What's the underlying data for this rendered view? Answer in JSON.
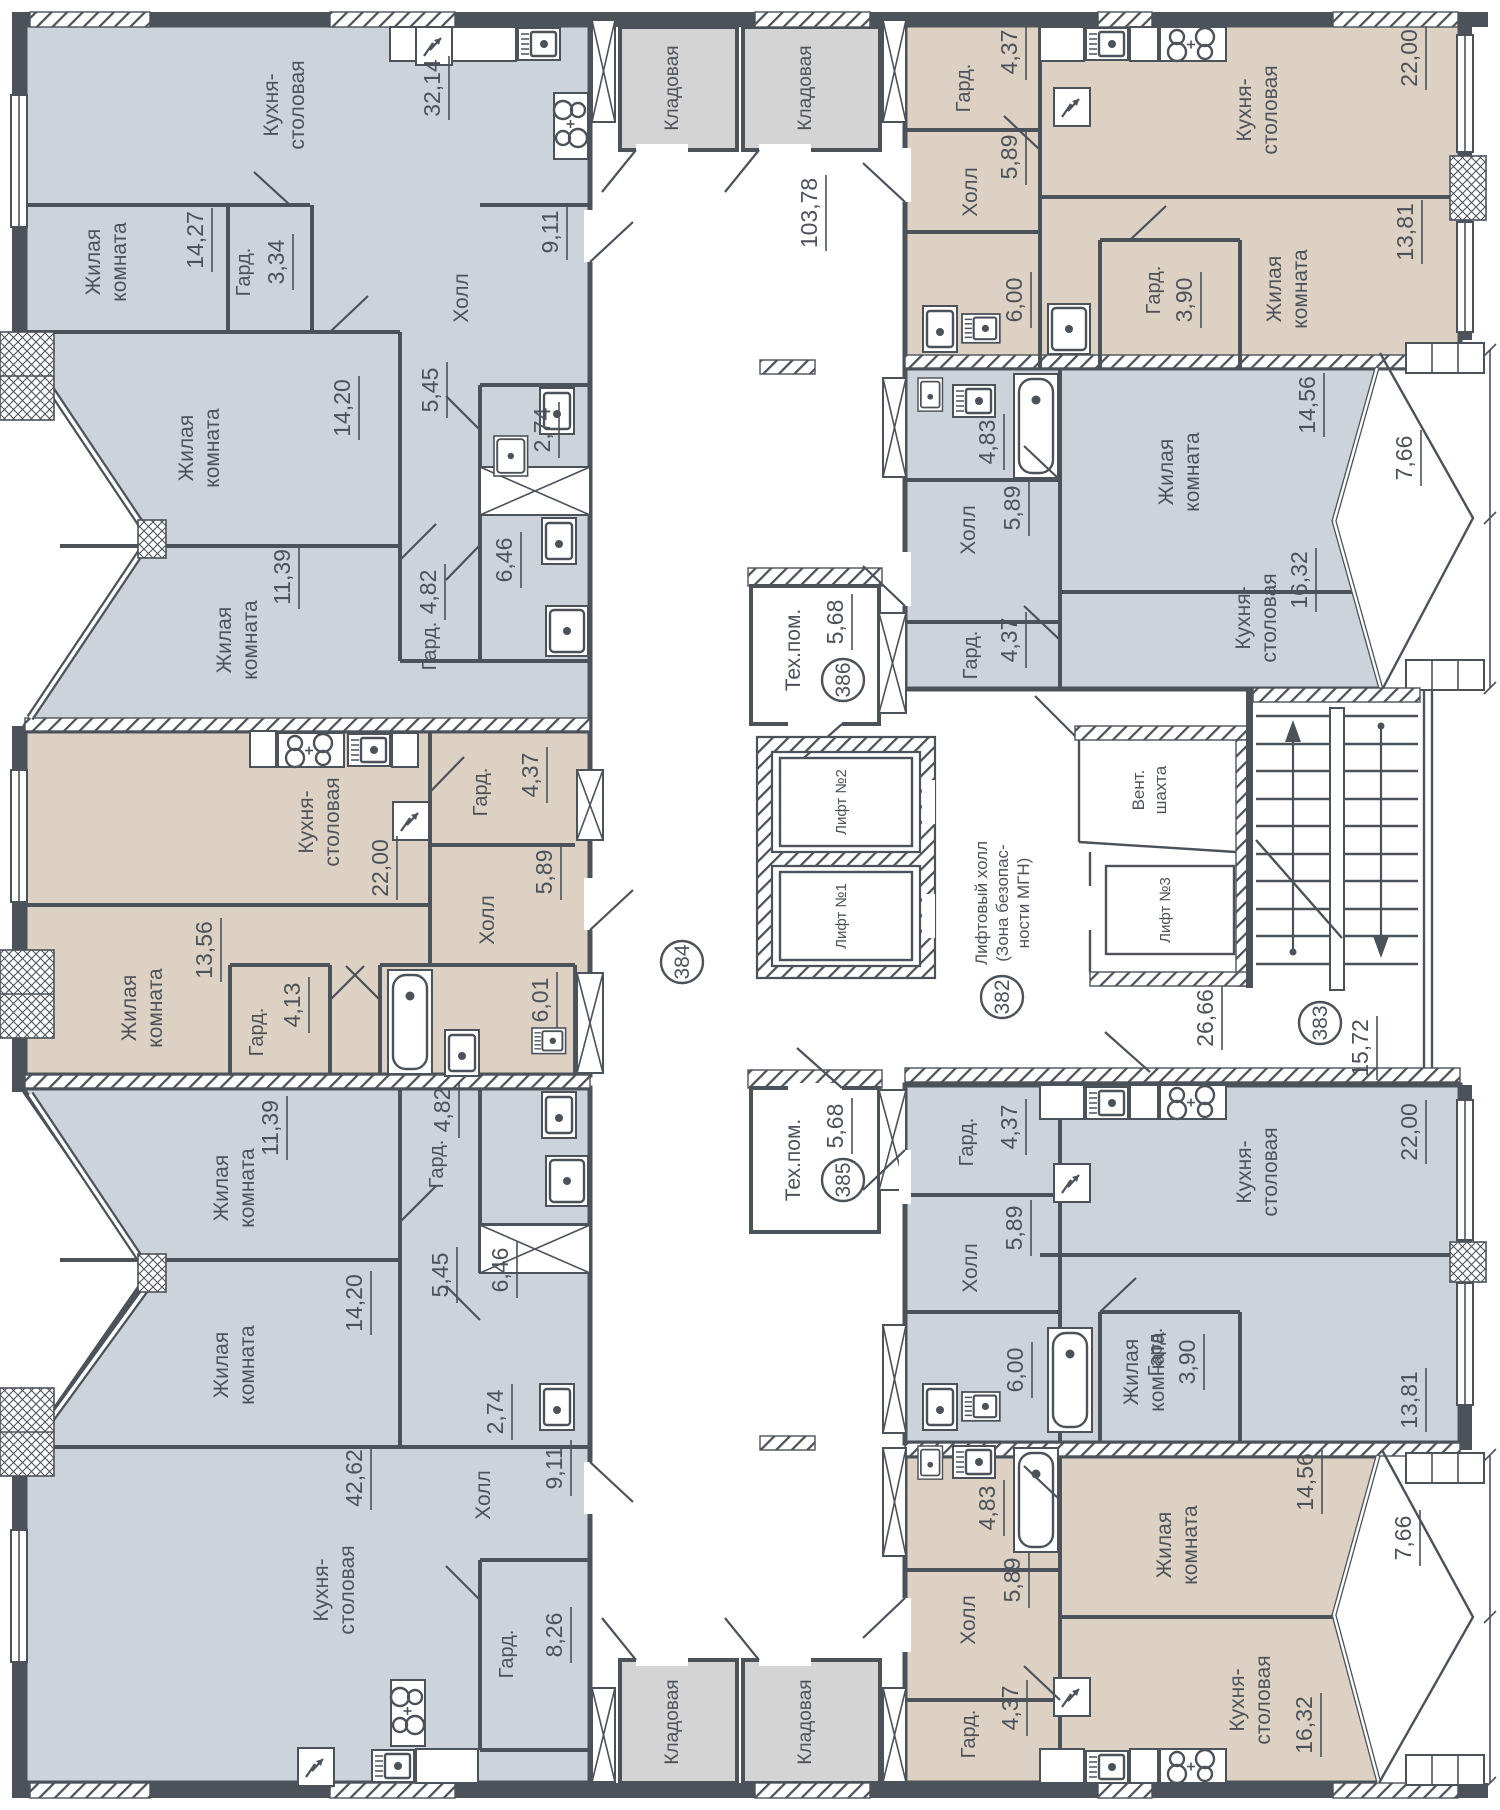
{
  "drawing": {
    "type": "floor-plan",
    "language": "ru"
  },
  "palette": {
    "room_cool": "#ccd3db",
    "room_warm": "#ddd1c3",
    "room_storage": "#d4d4d4",
    "line": "#4c525a",
    "white": "#ffffff"
  },
  "labels": {
    "kitchen_l1": "Кухня-",
    "kitchen_l2": "столовая",
    "living_l1": "Жилая",
    "living_l2": "комната",
    "hall": "Холл",
    "wardrobe": "Гард.",
    "storage": "Кладовая",
    "tech_room": "Тех.пом.",
    "lift_hall_l1": "Лифтовый холл",
    "lift_hall_l2": "(Зона безопас-",
    "lift_hall_l3": "ности МГН)",
    "vent_l1": "Вент.",
    "vent_l2": "шахта",
    "lift1": "Лифт №1",
    "lift2": "Лифт №2",
    "lift3": "Лифт №3"
  },
  "badges": {
    "a382": "382",
    "a383": "383",
    "a384": "384",
    "a385": "385",
    "a386": "386"
  },
  "areas": {
    "corridor": "103,78",
    "top_left": {
      "kitchen": "32,14",
      "living_a": "14,27",
      "wardrobe_a": "3,34",
      "hall": "9,11",
      "living_b": "14,20",
      "hall_b": "5,45",
      "living_c": "11,39",
      "wc": "2,74",
      "bath": "6,46",
      "wardrobe_b": "4,82"
    },
    "top_right": {
      "wardrobe_a": "4,37",
      "hall": "5,89",
      "bath": "6,00",
      "wardrobe_b": "3,90",
      "kitchen": "22,00",
      "living": "13,81"
    },
    "mid_right": {
      "bath": "4,83",
      "hall": "5,89",
      "wardrobe": "4,37",
      "living": "14,56",
      "kitchen": "16,32",
      "balcony": "7,66"
    },
    "left_center": {
      "kitchen": "22,00",
      "wardrobe_a": "4,37",
      "hall": "5,89",
      "living": "13,56",
      "wardrobe_b": "4,13",
      "bath": "6,01"
    },
    "bottom_left": {
      "living_a": "11,39",
      "wardrobe_a": "4,82",
      "bath": "6,46",
      "wc": "2,74",
      "hall_b": "5,45",
      "living_b": "14,20",
      "kitchen": "42,62",
      "hall": "9,11",
      "wardrobe_b": "8,26"
    },
    "bottom_right_upper": {
      "wardrobe_a": "4,37",
      "kitchen": "22,00",
      "hall": "5,89",
      "bath": "6,00",
      "wardrobe_b": "3,90",
      "living": "13,81"
    },
    "bottom_right_lower": {
      "bath": "4,83",
      "hall": "5,89",
      "wardrobe": "4,37",
      "living": "14,56",
      "kitchen": "16,32",
      "balcony": "7,66"
    },
    "core": {
      "tech_386": "5,68",
      "tech_385": "5,68",
      "stair_hall": "26,66",
      "hall_383": "15,72"
    }
  }
}
